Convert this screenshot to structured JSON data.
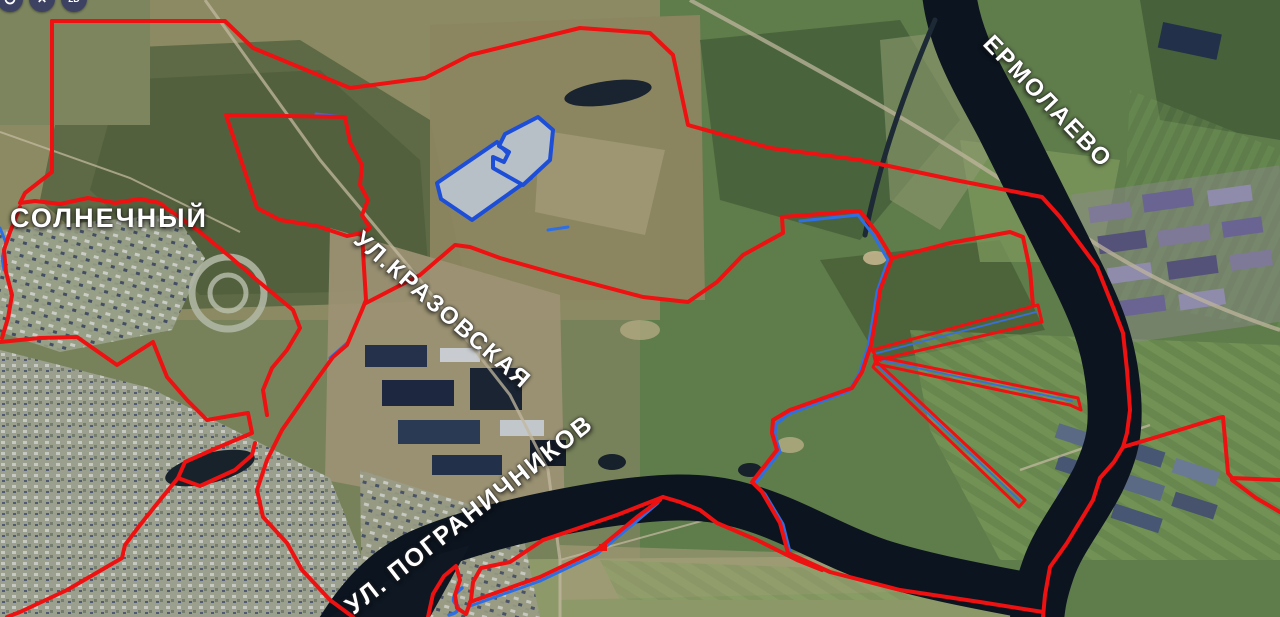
{
  "map": {
    "labels": [
      {
        "text": "СОЛНЕЧНЫЙ"
      },
      {
        "text": "ЕРМОЛАЕВО"
      },
      {
        "text": "УЛ.КРАЗОВСКАЯ"
      },
      {
        "text": "УЛ. ПОГРАНИЧНИКОВ"
      }
    ],
    "controls": {
      "rotate_tooltip": "rotate",
      "close_tooltip": "close",
      "mode_label": "2D"
    },
    "colors": {
      "boundary_red": "#ee1111",
      "utility_blue": "#2f6fe4",
      "parcel_fill": "#b7c0c7",
      "parcel_stroke": "#1d4ed8",
      "water": "#0c141f"
    }
  }
}
